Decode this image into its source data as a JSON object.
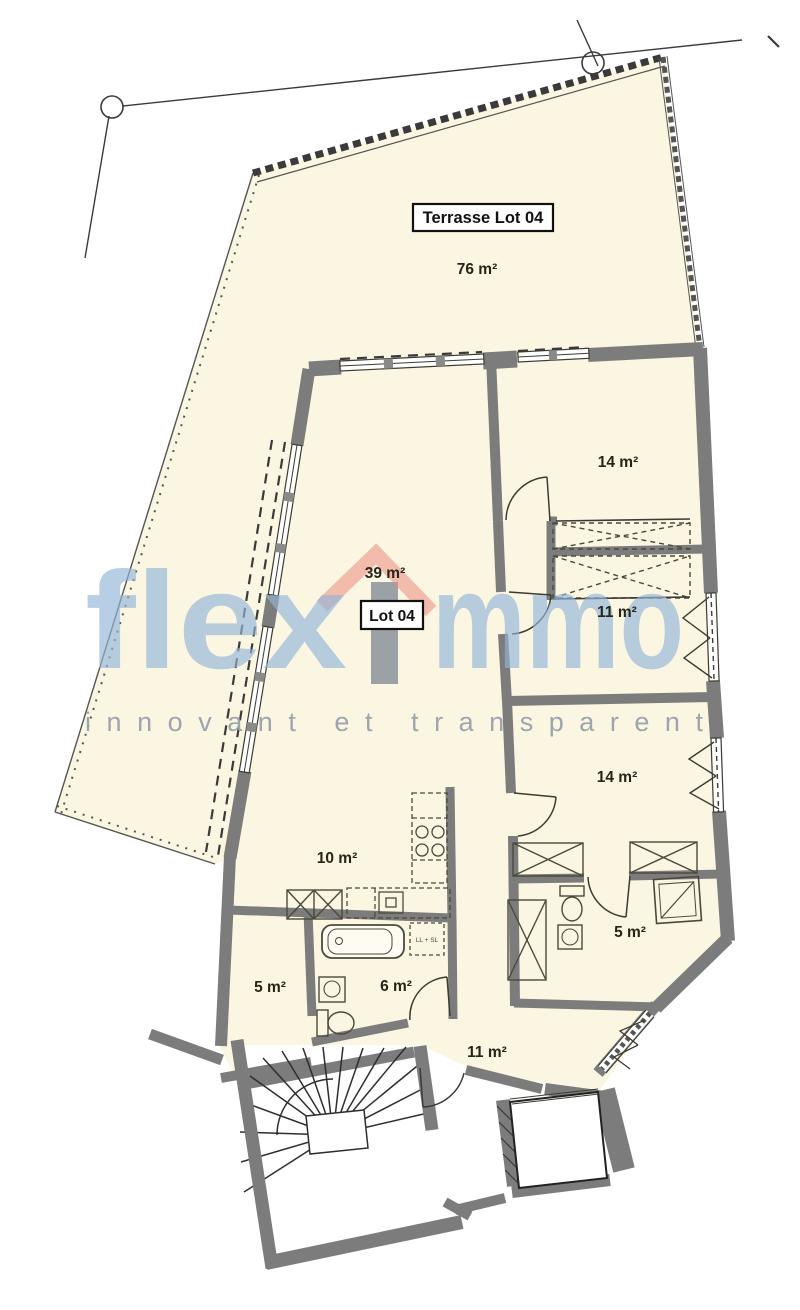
{
  "page": {
    "type": "architectural-floor-plan",
    "sheet": "apartment-lot-04"
  },
  "plan": {
    "terrace": {
      "title": "Terrasse Lot 04",
      "area": "76 m²"
    },
    "lot": {
      "title": "Lot 04",
      "area": "39 m²"
    },
    "rooms": {
      "bedroom_top": {
        "area": "14 m²"
      },
      "dressing": {
        "area": "11 m²"
      },
      "bedroom_bottom": {
        "area": "14 m²"
      },
      "kitchen": {
        "area": "10 m²"
      },
      "bathroom_right": {
        "area": "5 m²"
      },
      "storage_left": {
        "area": "5 m²"
      },
      "bathroom_center": {
        "area": "6 m²"
      },
      "hall": {
        "area": "11 m²"
      }
    },
    "appliances": {
      "washer_dryer": "LL + SL"
    }
  },
  "watermark": {
    "brand_prefix": "flex",
    "brand_suffix": "mmo",
    "tagline": "innovant et transparent",
    "text_color": "#93B5D9",
    "roof_color": "#EC8B80",
    "stem_color": "#848C97",
    "tagline_color": "#99A2AC"
  },
  "colors": {
    "floor": "#FBF6E1",
    "wall": "#7C7C7C",
    "line": "#3B3B32",
    "fixture": "#4A4A3C",
    "white": "#FFFFFF"
  }
}
